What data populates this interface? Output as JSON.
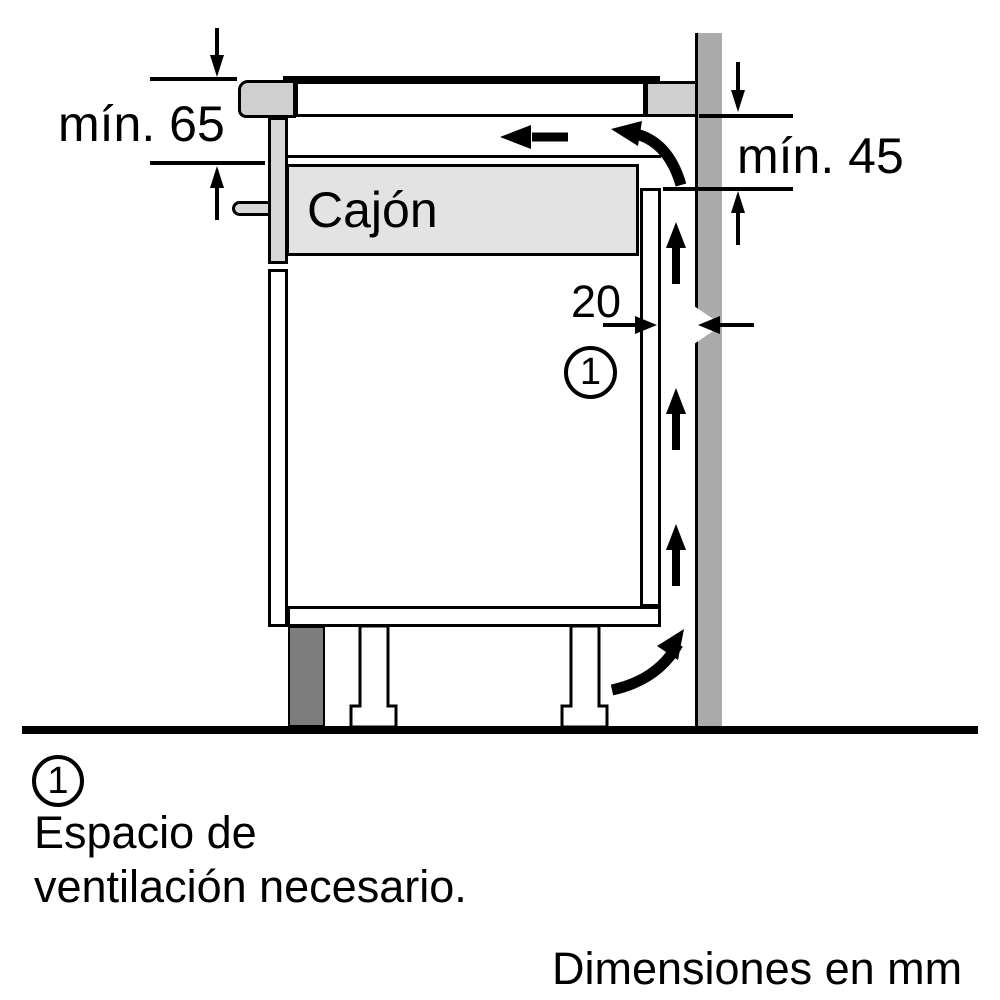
{
  "title": "Diagrama de instalación: espacio de ventilación",
  "colors": {
    "bg": "#ffffff",
    "line": "#000000",
    "wall": "#ababab",
    "worktop": "#cfcfcf",
    "front_panel": "#d8d8d8",
    "drawer_box": "#e3e3e3",
    "plinth": "#7d7d7d"
  },
  "diagram": {
    "labels": {
      "min_top_clearance": "mín. 65",
      "min_back_clearance": "mín. 45",
      "wall_gap": "20",
      "drawer": "Cajón"
    },
    "callout": {
      "number": "1"
    },
    "icons": [
      "airflow-arrow-left-icon",
      "airflow-corner-top-arrow-icon",
      "airflow-corner-bottom-arrow-icon",
      "airflow-arrow-up-icon",
      "dimension-arrow-down-icon",
      "dimension-arrow-up-icon",
      "dimension-arrow-right-icon",
      "dimension-arrow-left-icon"
    ]
  },
  "legend": {
    "callout_number": "1",
    "note_line1": "Espacio de",
    "note_line2": "ventilación necesario."
  },
  "footer": {
    "units_note": "Dimensiones en mm"
  }
}
